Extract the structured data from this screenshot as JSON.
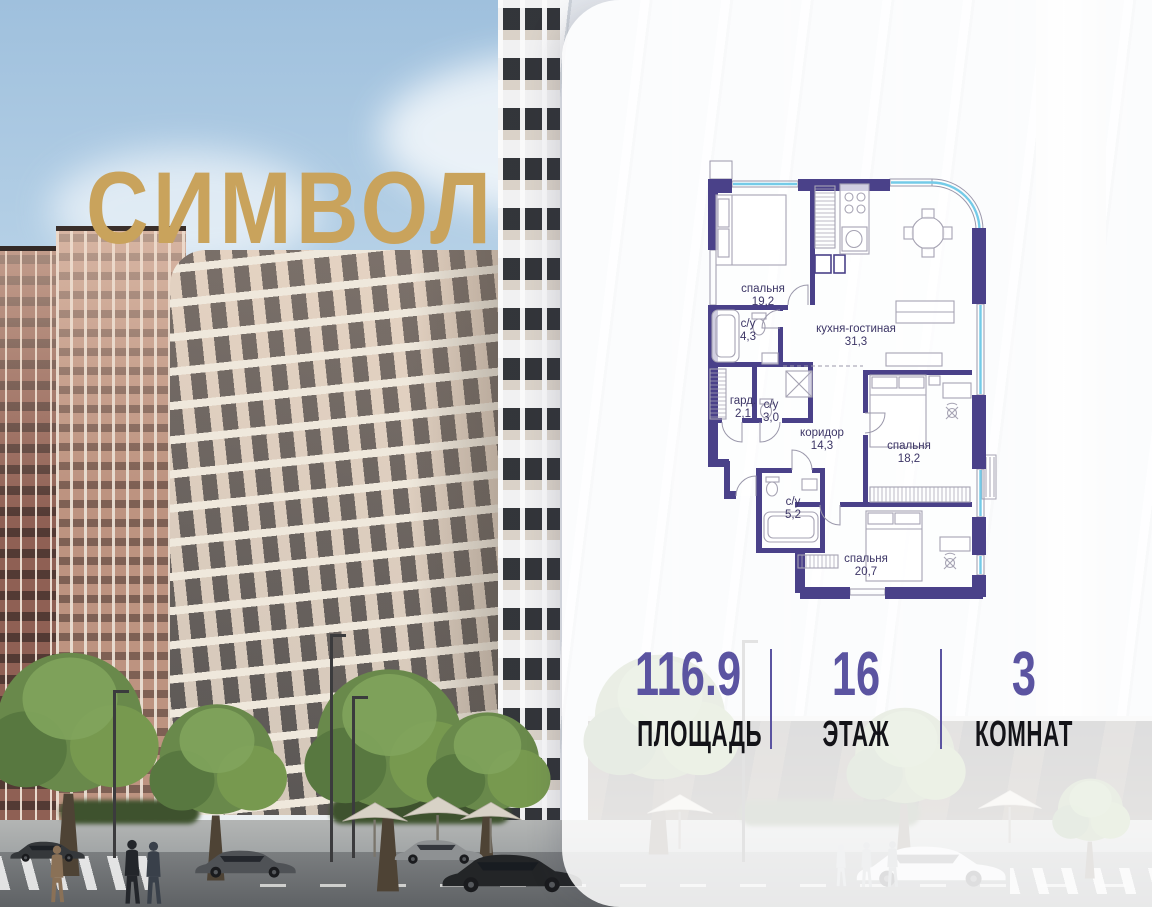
{
  "logo": {
    "text": "СИМВОЛ",
    "color": "#C9A35C"
  },
  "floor_plan": {
    "rooms": [
      {
        "name": "спальня",
        "area": "19,2"
      },
      {
        "name": "с/у",
        "area": "4,3"
      },
      {
        "name": "кухня-гостиная",
        "area": "31,3"
      },
      {
        "name": "гард.",
        "area": "2,1"
      },
      {
        "name": "с/у",
        "area": "3,0"
      },
      {
        "name": "коридор",
        "area": "14,3"
      },
      {
        "name": "спальня",
        "area": "18,2"
      },
      {
        "name": "с/у",
        "area": "5,2"
      },
      {
        "name": "спальня",
        "area": "20,7"
      }
    ],
    "colors": {
      "wall": "#4A4189",
      "glazing": "#74CBE8",
      "furniture": "#A6A3B3",
      "label": "#3C3566"
    }
  },
  "stats": {
    "items": [
      {
        "value": "116.9",
        "label": "ПЛОЩАДЬ"
      },
      {
        "value": "16",
        "label": "ЭТАЖ"
      },
      {
        "value": "3",
        "label": "КОМНАТ"
      }
    ],
    "value_color": "#5B54A1",
    "label_color": "#131318"
  }
}
